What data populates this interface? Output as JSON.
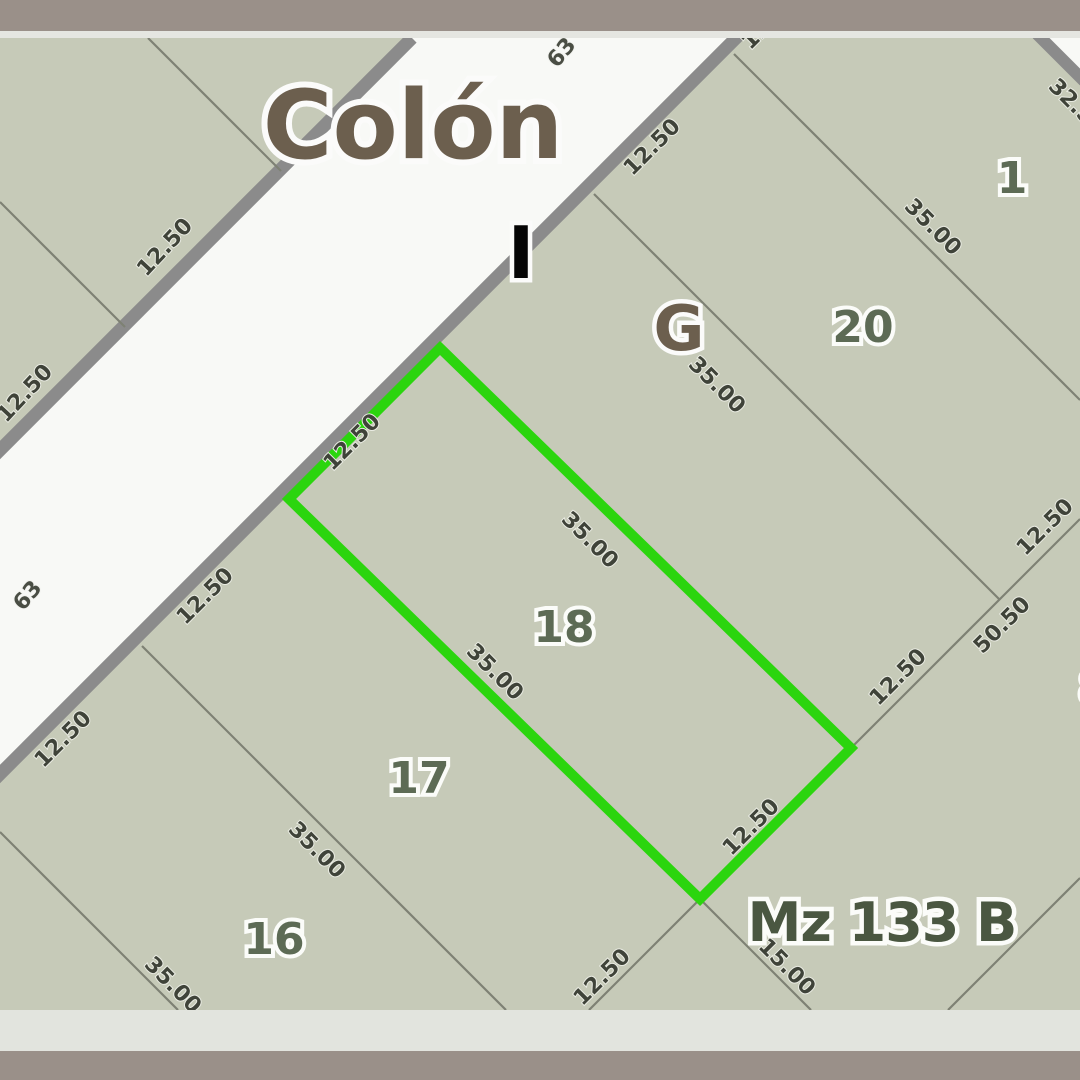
{
  "frame": {
    "top_bar_color": "#9a9089",
    "top_strip_color": "#e5e6e1",
    "bottom_strip_color": "#e2e4de",
    "bottom_bar_color": "#9a9089"
  },
  "map": {
    "background_color": "#c6cab8",
    "street_fill": "#f8f9f6",
    "street_edge_color": "#8b8b8b",
    "parcel_line_color": "#7e8174",
    "highlight_color": "#2bd50e",
    "street_name": "Colón",
    "block_label": "Mz 133 B",
    "letters": [
      "I",
      "G"
    ],
    "parcel_numbers": [
      "16",
      "17",
      "18",
      "20",
      "1",
      "8"
    ],
    "street_numbers": [
      "63",
      "63"
    ],
    "dimensions": [
      "12.50",
      "12.50",
      "12.50",
      "12.50",
      "12.50",
      "12.50",
      "12.50",
      "12.50",
      "12.50",
      "12.50",
      "50.50",
      "35.00",
      "35.00",
      "35.00",
      "35.00",
      "35.00",
      "35.00",
      "15.00",
      "32.50",
      "12.50"
    ],
    "highlighted_parcel": "18"
  }
}
